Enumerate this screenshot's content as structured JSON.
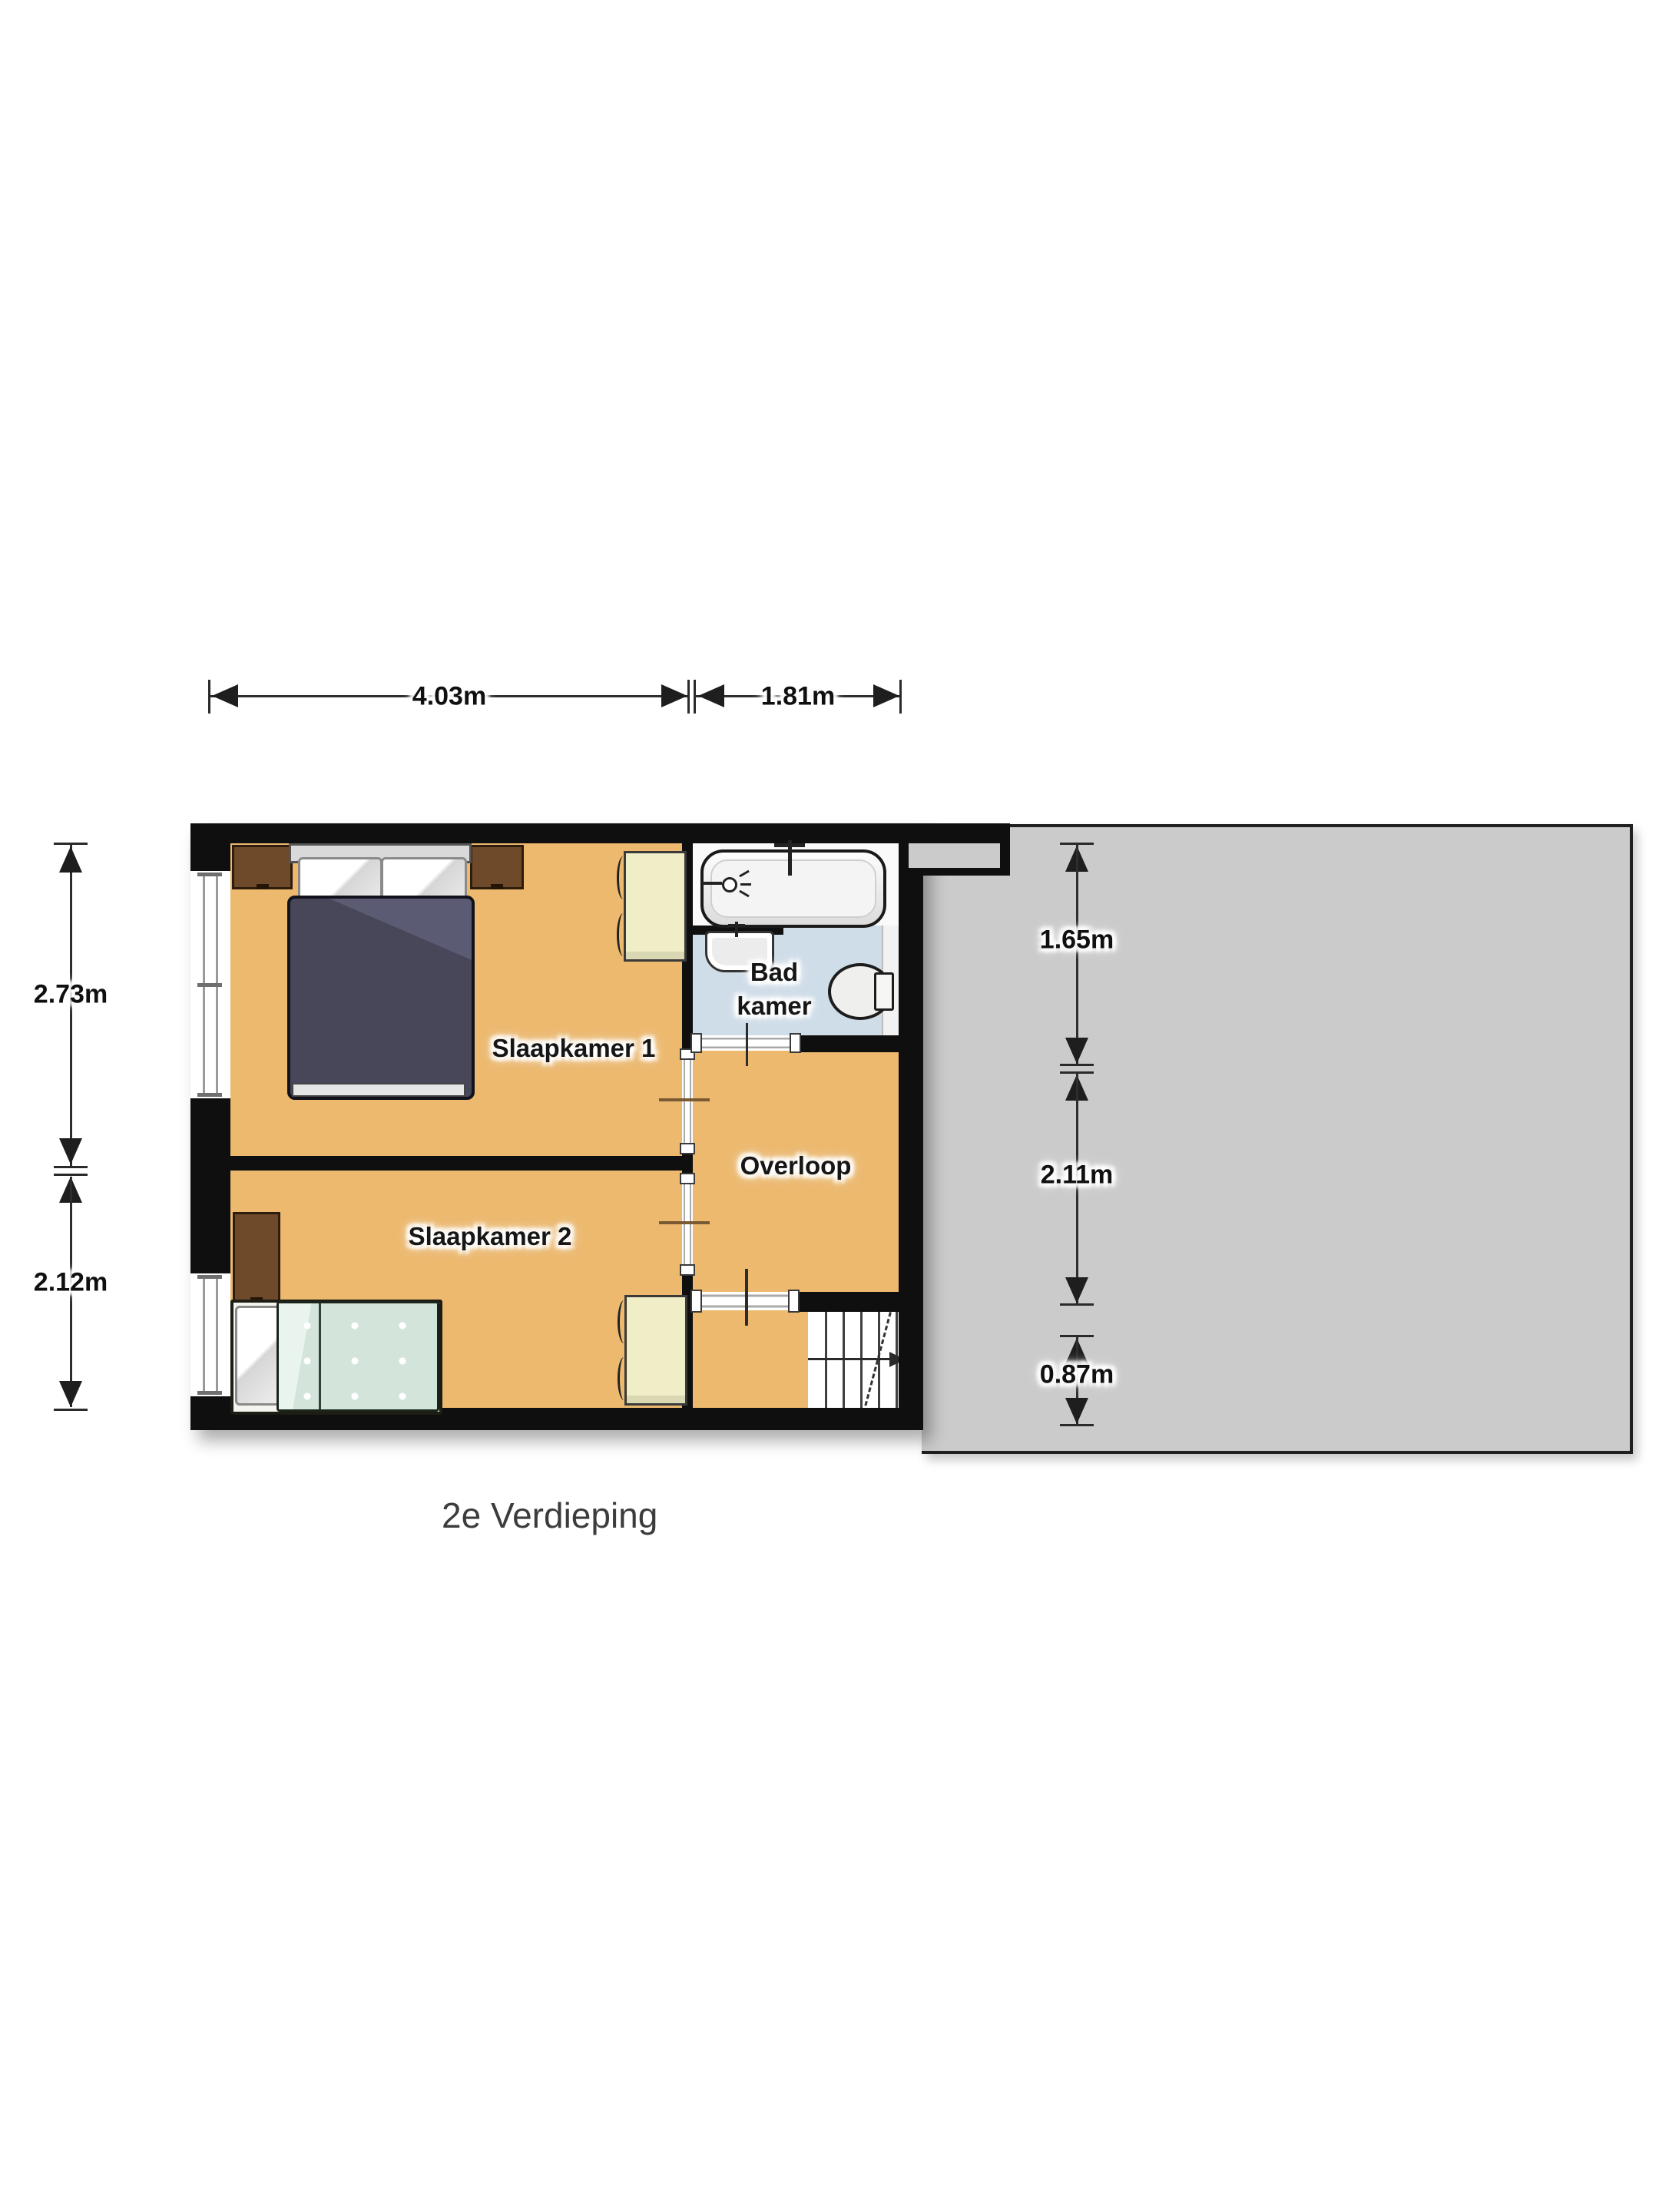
{
  "floor_title": "2e Verdieping",
  "rooms": {
    "bedroom1": "Slaapkamer 1",
    "bedroom2": "Slaapkamer 2",
    "bathroom_line1": "Bad",
    "bathroom_line2": "kamer",
    "landing": "Overloop"
  },
  "dimensions": {
    "top": [
      {
        "label": "4.03m"
      },
      {
        "label": "1.81m"
      }
    ],
    "left": [
      {
        "label": "2.73m"
      },
      {
        "label": "2.12m"
      }
    ],
    "right": [
      {
        "label": "1.65m"
      },
      {
        "label": "2.11m"
      },
      {
        "label": "0.87m"
      }
    ]
  },
  "colors": {
    "wall": "#0f0f0f",
    "floor": "#ecb96f",
    "bathroom_floor": "#cfdde9",
    "roof_area": "#cbcbcb",
    "wardrobe": "#efeec6",
    "wood_furniture": "#6e4a2b",
    "duvet_double": "#474759",
    "duvet_single": "#d3e5da",
    "dimension_line": "#2d2d2d"
  }
}
